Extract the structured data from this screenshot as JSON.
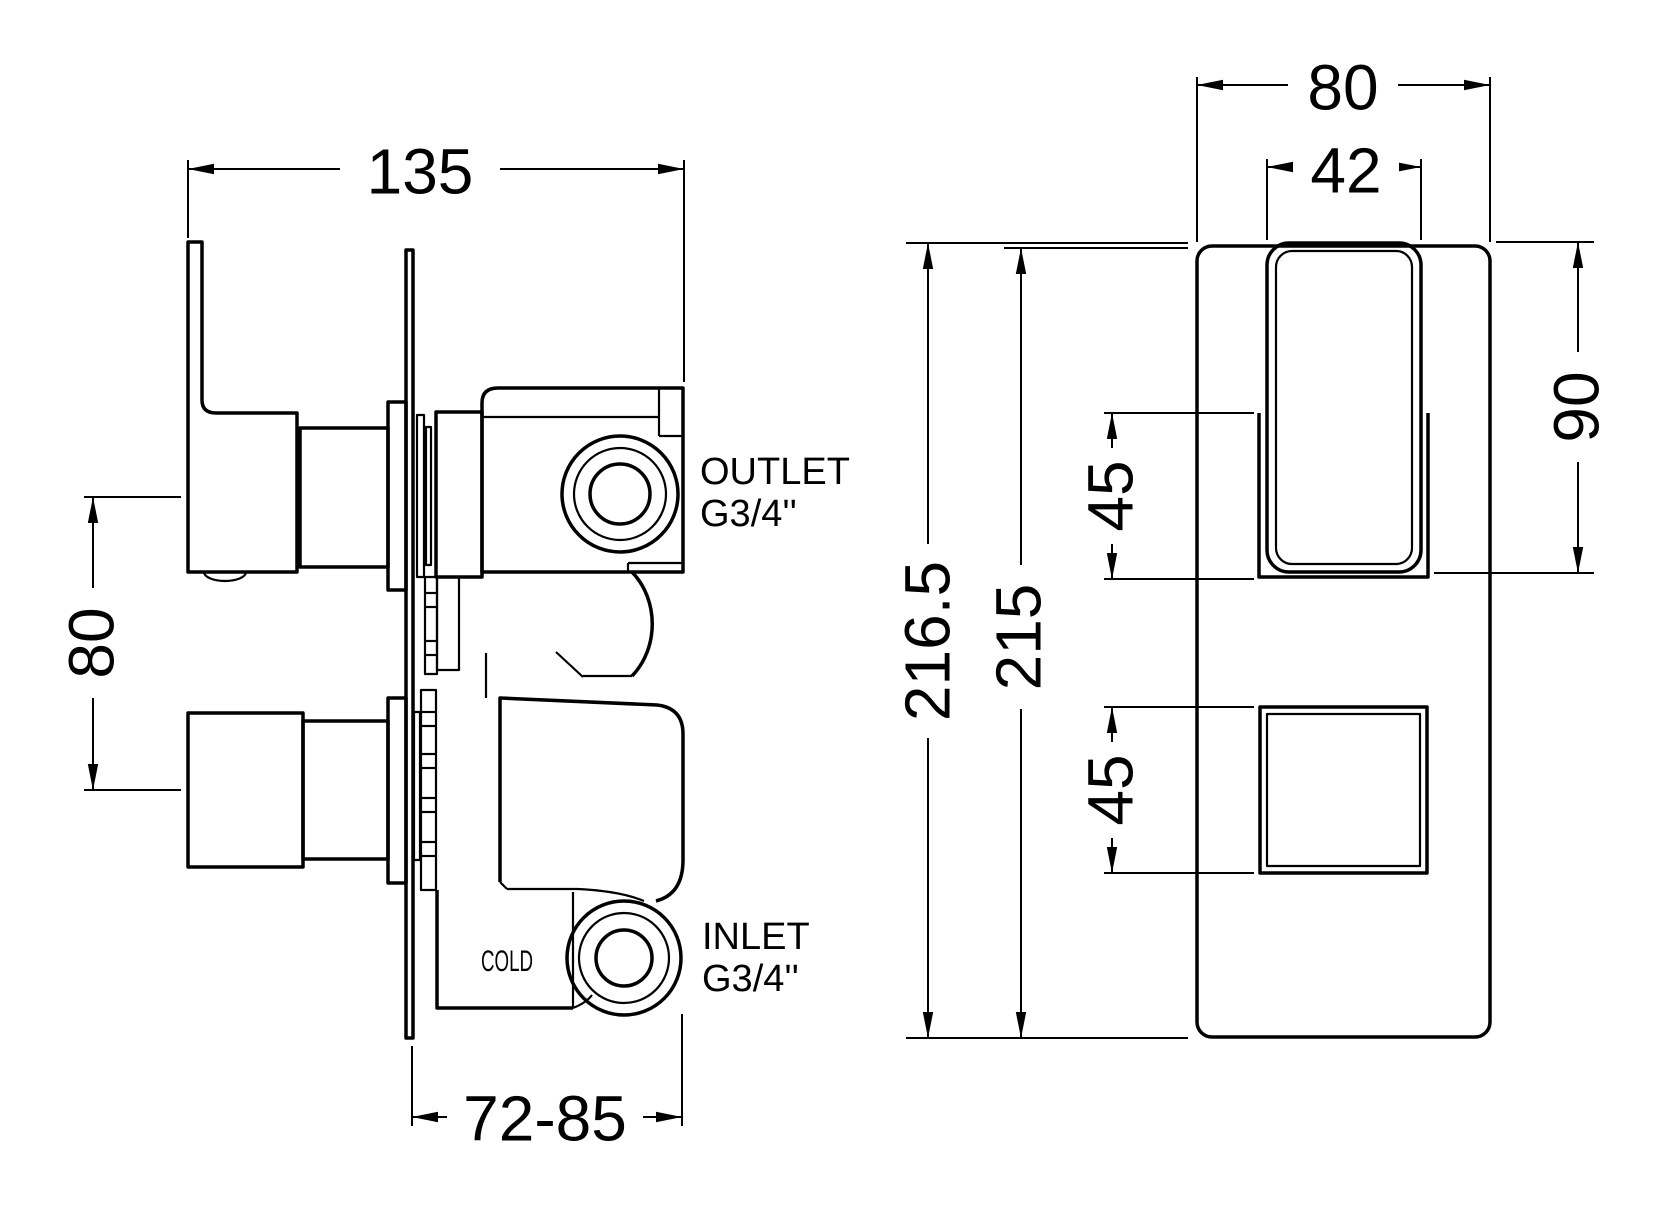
{
  "drawing": {
    "type": "technical-dimension-drawing",
    "subject": "concealed thermostatic shower valve",
    "side_view": {
      "dim_depth_total": "135",
      "dim_handle_spacing": "80",
      "dim_install_depth": "72-85",
      "outlet_line1": "OUTLET",
      "outlet_line2": "G3/4''",
      "inlet_line1": "INLET",
      "inlet_line2": "G3/4''",
      "cold": "COLD"
    },
    "front_view": {
      "dim_plate_width": "80",
      "dim_handle_width": "42",
      "dim_total_height": "216.5",
      "dim_plate_height": "215",
      "dim_handle_offset": "45",
      "dim_knob_size": "45",
      "dim_handle_height": "90"
    },
    "colors": {
      "line": "#000000",
      "background": "#ffffff"
    }
  }
}
